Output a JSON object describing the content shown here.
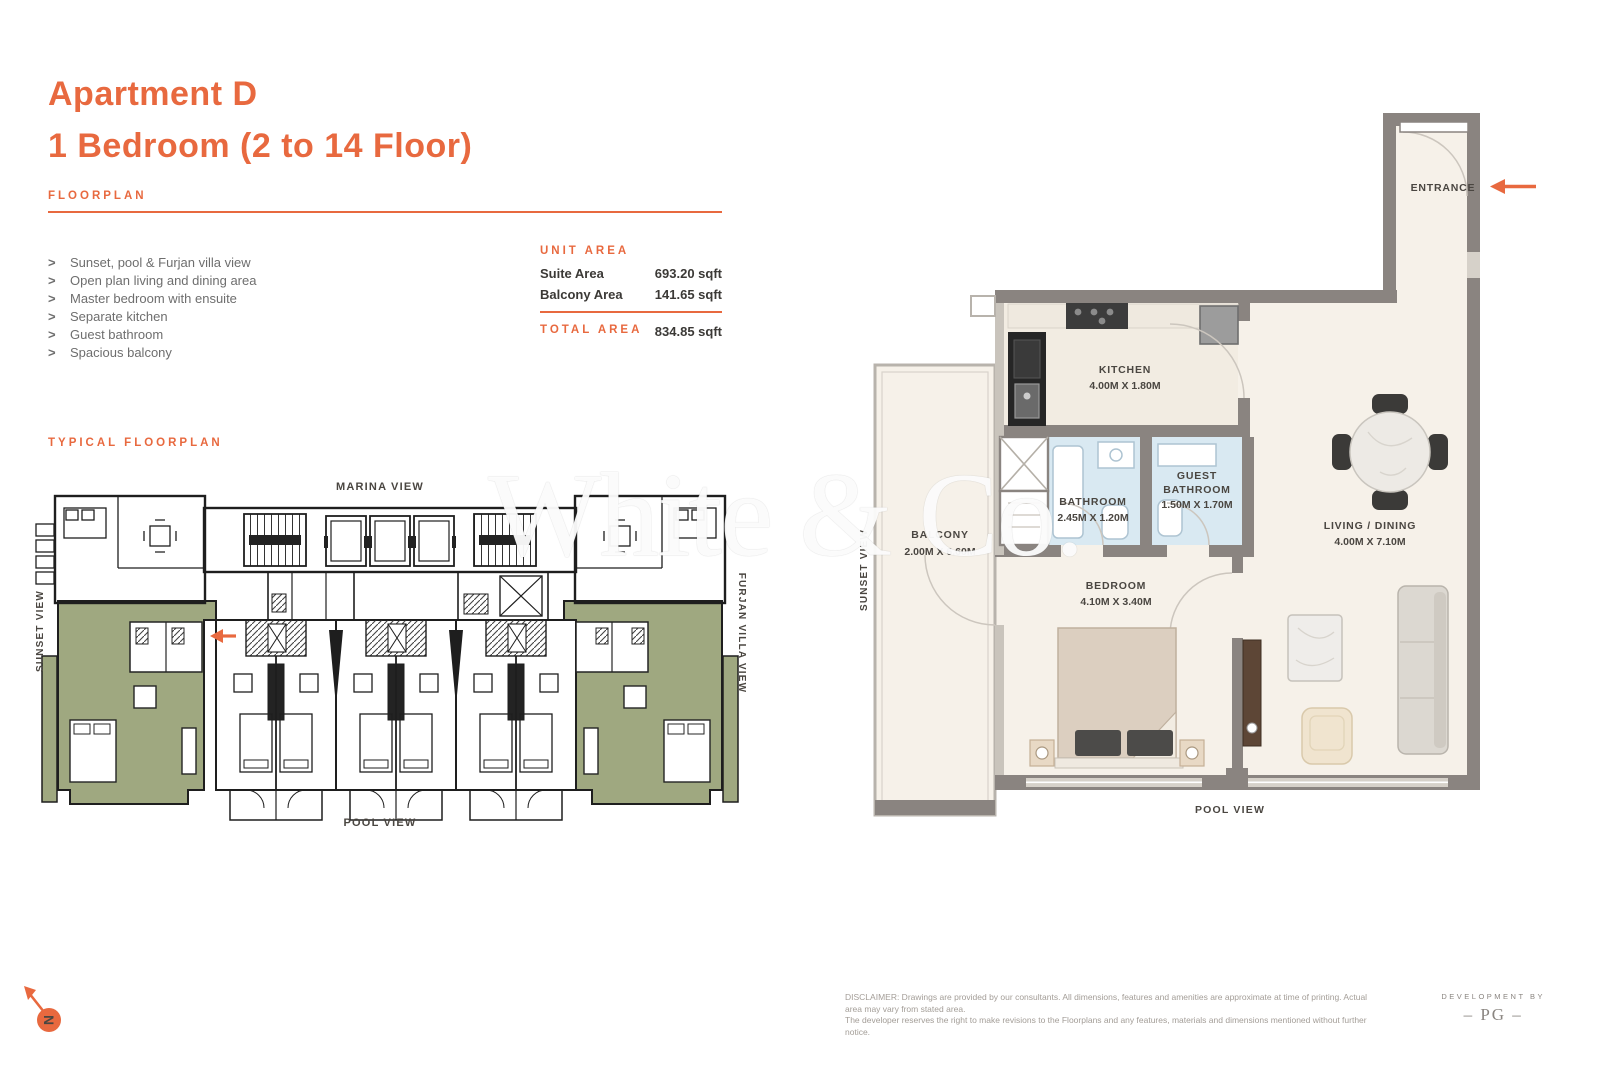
{
  "page": {
    "title_line1": "Apartment D",
    "title_line2": "1 Bedroom (2 to 14 Floor)",
    "floorplan_label": "FLOORPLAN",
    "typical_floorplan_label": "TYPICAL FLOORPLAN"
  },
  "features_meta": {
    "bullet": ">"
  },
  "features": [
    "Sunset, pool & Furjan villa view",
    "Open plan living and dining area",
    "Master bedroom with ensuite",
    "Separate kitchen",
    "Guest bathroom",
    "Spacious balcony"
  ],
  "unit_area": {
    "heading": "UNIT AREA",
    "rows": [
      {
        "label": "Suite Area",
        "value": "693.20 sqft"
      },
      {
        "label": "Balcony Area",
        "value": "141.65 sqft"
      }
    ],
    "total_label": "TOTAL AREA",
    "total_value": "834.85 sqft"
  },
  "key_plan": {
    "marina_view": "MARINA VIEW",
    "pool_view": "POOL VIEW",
    "sunset_view": "SUNSET VIEW",
    "furjan_villa_view": "FURJAN VILLA VIEW"
  },
  "unit_plan": {
    "entrance": "ENTRANCE",
    "kitchen": {
      "name": "KITCHEN",
      "dims": "4.00M X 1.80M"
    },
    "bathroom": {
      "name": "BATHROOM",
      "dims": "2.45M X 1.20M"
    },
    "guest_bathroom": {
      "line1": "GUEST",
      "line2": "BATHROOM",
      "dims": "1.50M X 1.70M"
    },
    "living_dining": {
      "name": "LIVING / DINING",
      "dims": "4.00M X 7.10M"
    },
    "bedroom": {
      "name": "BEDROOM",
      "dims": "4.10M X 3.40M"
    },
    "balcony": {
      "name": "BALCONY",
      "dims": "2.00M X 6.60M"
    },
    "labels": {
      "pool_view": "POOL VIEW",
      "sunset_view": "SUNSET VIEW"
    }
  },
  "branding": {
    "watermark": "White & Co.",
    "compass_letter": "N",
    "development_by": "DEVELOPMENT BY",
    "developer_logo": "– PG –"
  },
  "footer": {
    "disclaimer_line1": "DISCLAIMER: Drawings are provided by our consultants. All dimensions, features and amenities are approximate at time of printing. Actual area may vary from stated area.",
    "disclaimer_line2": "The developer reserves the right to make revisions to the Floorplans and any features, materials and dimensions mentioned without further notice."
  },
  "colors": {
    "accent_orange": "#E8693F",
    "highlight_green": "#9FA880",
    "wall_gray": "#8A8480",
    "bathroom_blue": "#D9E9F2",
    "floor_cream": "#F6F1E9"
  }
}
